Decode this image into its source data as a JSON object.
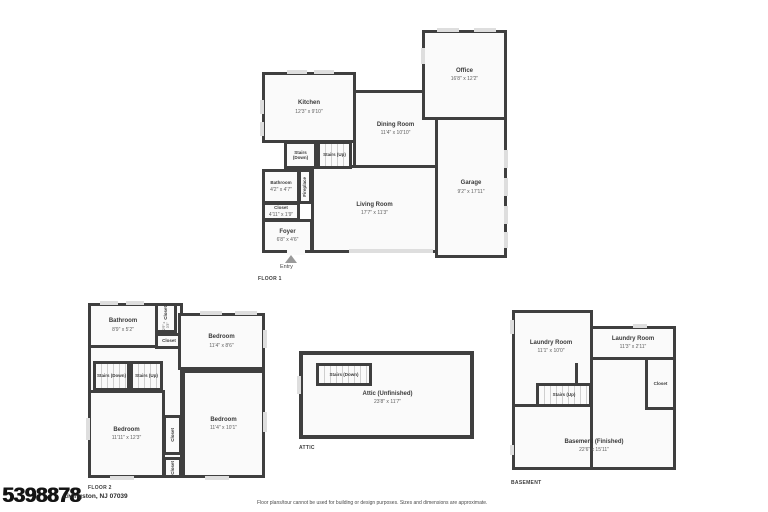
{
  "page": {
    "listing_id": "5398878",
    "address": "Livingston, NJ 07039",
    "disclaimer": "Floor plans/tour cannot be used for building or design purposes. Sizes and dimensions are approximate."
  },
  "floor1": {
    "label": "FLOOR 1",
    "entry_label": "Entry",
    "rooms": {
      "kitchen": {
        "name": "Kitchen",
        "dims": "12'3\" x 9'10\""
      },
      "dining": {
        "name": "Dining Room",
        "dims": "11'4\" x 10'10\""
      },
      "office": {
        "name": "Office",
        "dims": "16'8\" x 12'2\""
      },
      "garage": {
        "name": "Garage",
        "dims": "9'2\" x 17'11\""
      },
      "living": {
        "name": "Living Room",
        "dims": "17'7\" x 11'3\""
      },
      "foyer": {
        "name": "Foyer",
        "dims": "6'8\" x 4'6\""
      },
      "bathroom": {
        "name": "Bathroom",
        "dims": "4'2\" x 4'7\""
      },
      "closet": {
        "name": "Closet",
        "dims": "4'11\" x 1'9\""
      },
      "fireplace": {
        "name": "Fireplace"
      },
      "stairs_down": {
        "name": "Stairs (Down)"
      },
      "stairs_up": {
        "name": "Stairs (Up)"
      }
    }
  },
  "floor2": {
    "label": "FLOOR 2",
    "rooms": {
      "bathroom": {
        "name": "Bathroom",
        "dims": "8'9\" x 5'2\""
      },
      "closet_tall": {
        "name": "Closet",
        "dims": "2'9\" x 3'3\""
      },
      "closet_small": {
        "name": "Closet"
      },
      "bedroom_tr": {
        "name": "Bedroom",
        "dims": "11'4\" x 8'6\""
      },
      "bedroom_bl": {
        "name": "Bedroom",
        "dims": "11'11\" x 12'3\""
      },
      "bedroom_br": {
        "name": "Bedroom",
        "dims": "11'4\" x 10'1\""
      },
      "closet_mid": {
        "name": "Closet"
      },
      "closet_bot": {
        "name": "Closet"
      },
      "stairs_down": {
        "name": "Stairs (Down)"
      },
      "stairs_up": {
        "name": "Stairs (Up)"
      }
    }
  },
  "attic": {
    "label": "ATTIC",
    "rooms": {
      "attic": {
        "name": "Attic (Unfinished)",
        "dims": "23'8\" x 11'7\""
      },
      "stairs_down": {
        "name": "Stairs (Down)"
      }
    }
  },
  "basement": {
    "label": "BASEMENT",
    "rooms": {
      "laundry_left": {
        "name": "Laundry Room",
        "dims": "11'1\" x 10'0\""
      },
      "laundry_right": {
        "name": "Laundry Room",
        "dims": "11'3\" x 2'11\""
      },
      "closet": {
        "name": "Closet"
      },
      "stairs_up": {
        "name": "Stairs (Up)"
      },
      "basement": {
        "name": "Basement (Finished)",
        "dims": "22'6\" x 15'11\""
      }
    }
  }
}
